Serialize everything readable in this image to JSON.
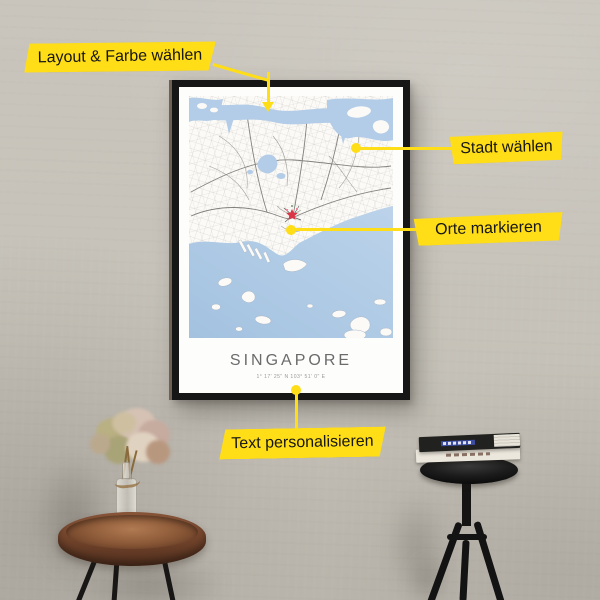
{
  "scene": {
    "description_note": "framed Singapore map poster on concrete wall with annotation callouts",
    "wall_color": "#c6c2b9"
  },
  "callouts": {
    "accent_color": "#ffdd17",
    "items": [
      {
        "id": "layout",
        "label": "Layout & Farbe wählen"
      },
      {
        "id": "city",
        "label": "Stadt wählen"
      },
      {
        "id": "places",
        "label": "Orte markieren"
      },
      {
        "id": "personalize",
        "label": "Text personalisieren"
      }
    ]
  },
  "poster": {
    "title": "SINGAPORE",
    "coordinates": "1° 17' 25\" N  103° 51' 0\" E",
    "frame_color": "#161616",
    "map": {
      "land_color": "#fbfaf7",
      "water_color": "#b3cce7",
      "road_color": "#85837d",
      "marker_color": "#d93648"
    }
  }
}
